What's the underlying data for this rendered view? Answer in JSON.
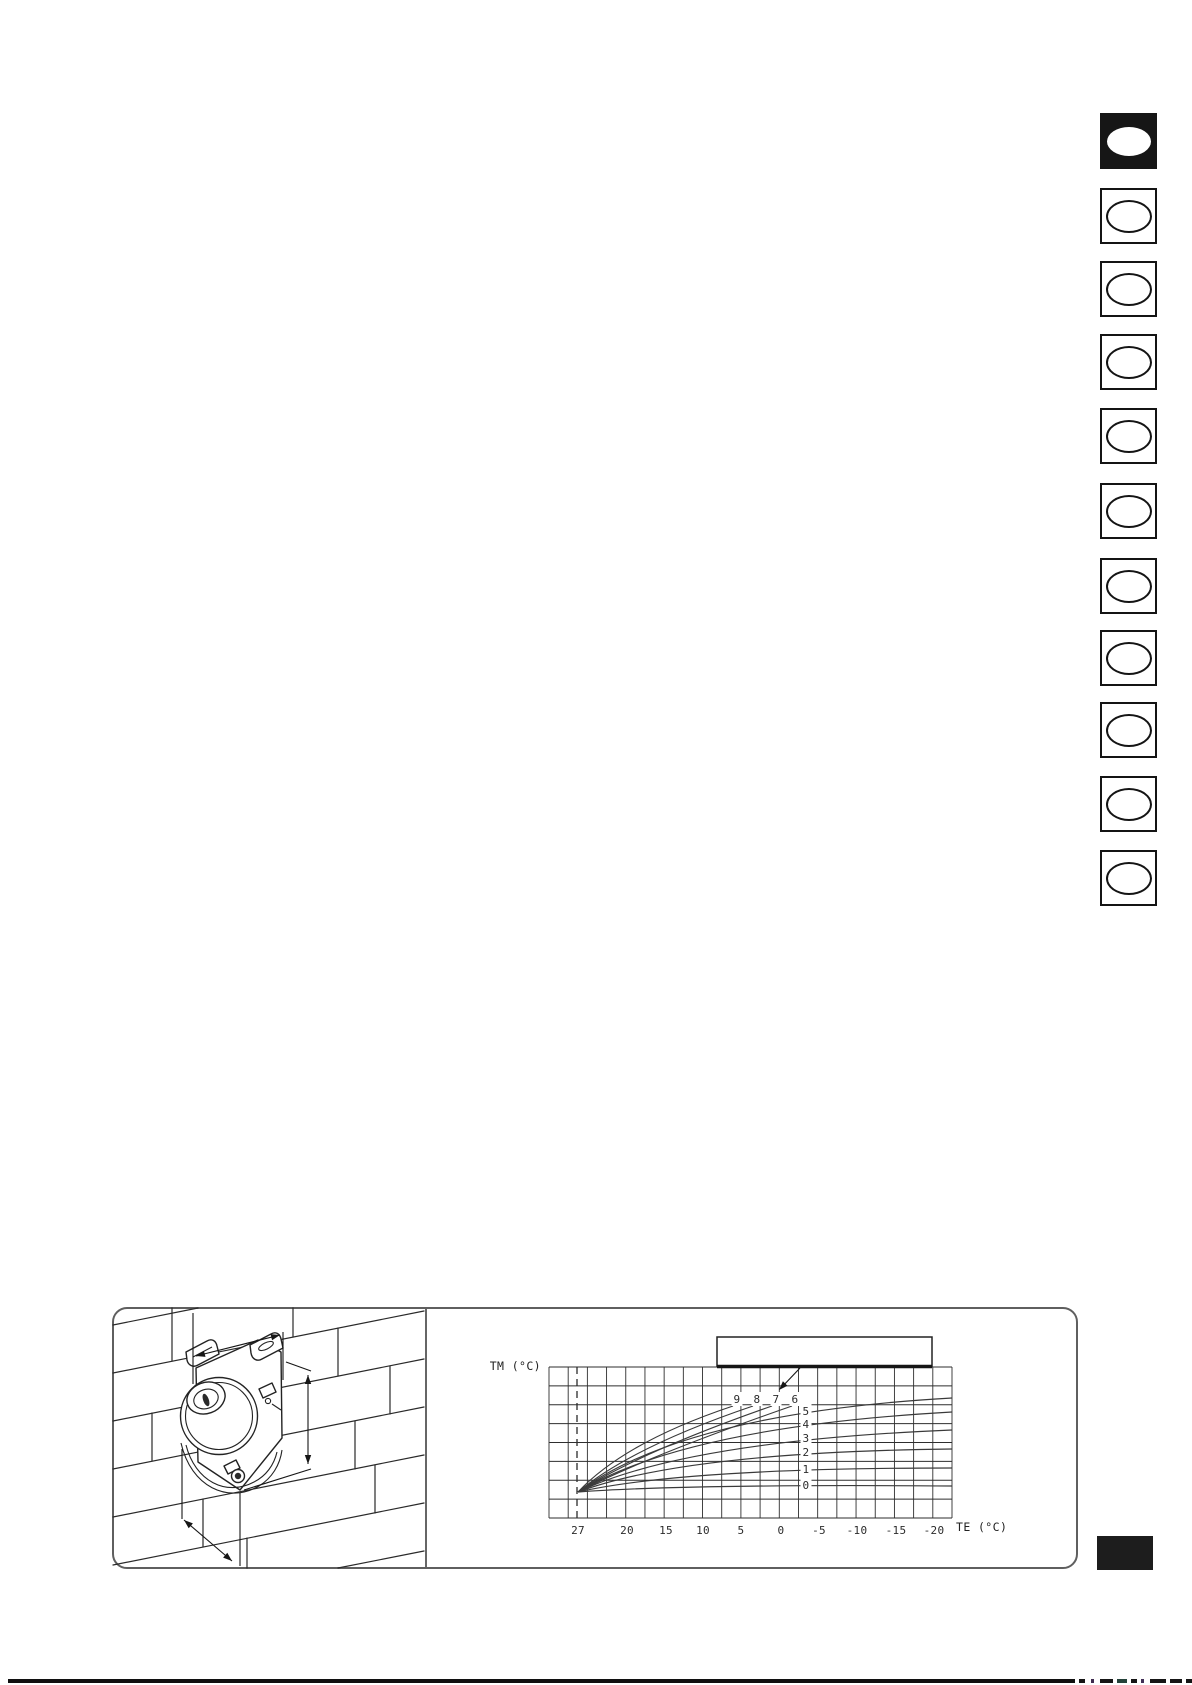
{
  "page": {
    "background": "#ffffff",
    "ink_color": "#1a1a1a",
    "language_tabs": [
      {
        "active": true
      },
      {
        "active": false
      },
      {
        "active": false
      },
      {
        "active": false
      },
      {
        "active": false
      },
      {
        "active": false
      },
      {
        "active": false
      },
      {
        "active": false
      },
      {
        "active": false
      },
      {
        "active": false
      },
      {
        "active": false
      }
    ],
    "section_marker_color": "#1d1d1d",
    "footer_rule_color": "#101010"
  },
  "figure": {
    "border_color": "#5f5f5f",
    "callout_box_label": ""
  },
  "chart_data": {
    "type": "line",
    "title": "",
    "xlabel": "TE (°C)",
    "ylabel": "TM (°C)",
    "x_ticks": [
      "27",
      "20",
      "15",
      "10",
      "5",
      "0",
      "-5",
      "-10",
      "-15",
      "-20"
    ],
    "x_axis_reversed": true,
    "x_range": [
      30,
      -22.5
    ],
    "y_ticks": [],
    "grid": true,
    "curve_labels": [
      "9",
      "8",
      "7",
      "6",
      "5",
      "4",
      "3",
      "2",
      "1",
      "0"
    ],
    "render": {
      "plot": {
        "x": 549,
        "y": 1367,
        "w": 403,
        "h": 151,
        "cols": 21,
        "rows": 8
      },
      "bold_top_segment": [
        717,
        932
      ],
      "dashed_line_x": 577,
      "x_tick_px": [
        578,
        627,
        666,
        703,
        741,
        781,
        819,
        857,
        896,
        934
      ],
      "x_tick_baseline_y": 1534,
      "origin": [
        578,
        1492
      ],
      "curves": [
        {
          "label": "9",
          "ctrl": [
            625,
            1442
          ],
          "end": [
            733,
            1406
          ],
          "label_pos": [
            737,
            1399
          ]
        },
        {
          "label": "8",
          "ctrl": [
            632,
            1447
          ],
          "end": [
            753,
            1406
          ],
          "label_pos": [
            757,
            1399
          ]
        },
        {
          "label": "7",
          "ctrl": [
            640,
            1452
          ],
          "end": [
            772,
            1406
          ],
          "label_pos": [
            776,
            1399
          ]
        },
        {
          "label": "6",
          "ctrl": [
            648,
            1456
          ],
          "end": [
            792,
            1406
          ],
          "label_pos": [
            795,
            1399
          ]
        },
        {
          "label": "5",
          "ctrl": [
            685,
            1413
          ],
          "end": [
            952,
            1398
          ],
          "label_pos": [
            806,
            1411
          ]
        },
        {
          "label": "4",
          "ctrl": [
            685,
            1427
          ],
          "end": [
            952,
            1412
          ],
          "label_pos": [
            806,
            1424
          ]
        },
        {
          "label": "3",
          "ctrl": [
            685,
            1441
          ],
          "end": [
            952,
            1430
          ],
          "label_pos": [
            806,
            1438
          ]
        },
        {
          "label": "2",
          "ctrl": [
            685,
            1452
          ],
          "end": [
            952,
            1449
          ],
          "label_pos": [
            806,
            1452
          ]
        },
        {
          "label": "1",
          "ctrl": [
            685,
            1468
          ],
          "end": [
            952,
            1468
          ],
          "label_pos": [
            806,
            1469
          ]
        },
        {
          "label": "0",
          "ctrl": [
            685,
            1484
          ],
          "end": [
            952,
            1486
          ],
          "label_pos": [
            806,
            1485
          ]
        }
      ]
    }
  }
}
